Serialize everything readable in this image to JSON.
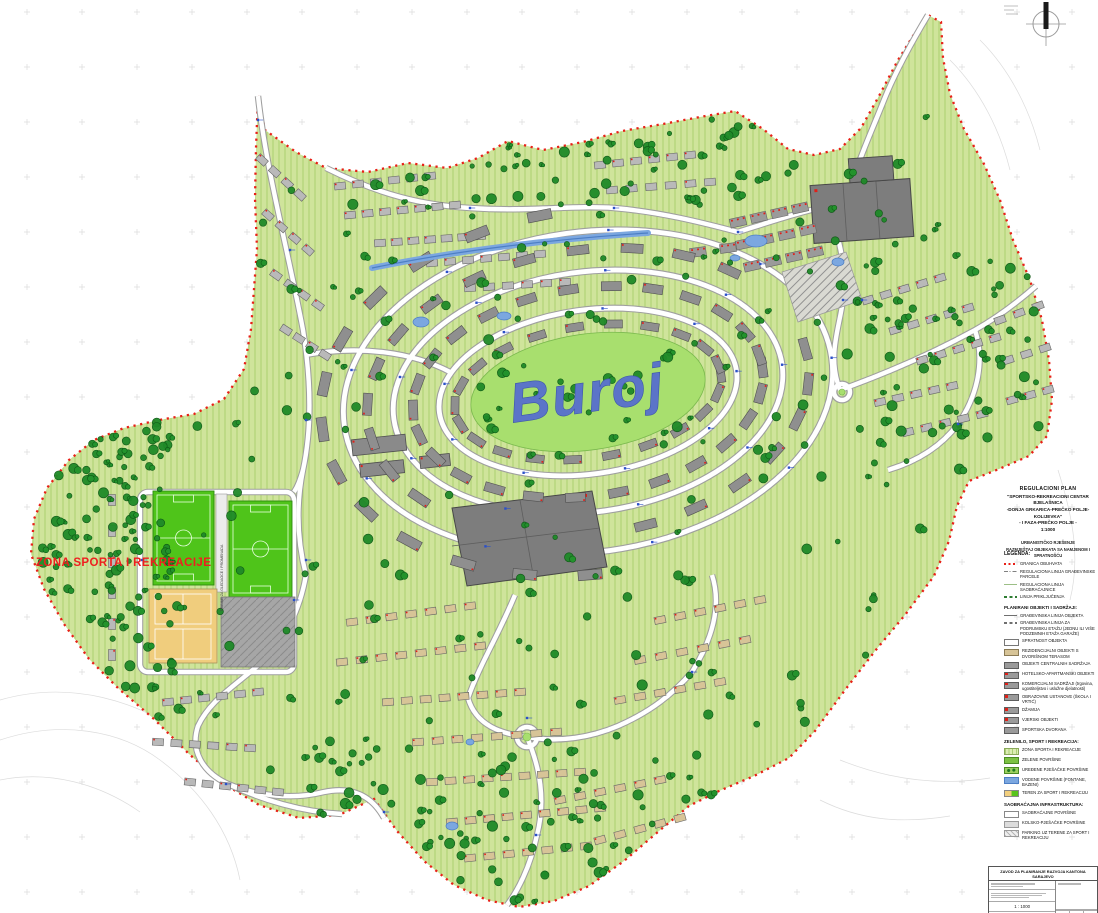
{
  "map": {
    "brand_label": "Buroj",
    "sport_zone_label": "ZONA SPORTA I REKREACIJE",
    "tribune_label": "TRIBINE ZA GLEDAOCE I PROMENADA"
  },
  "title_block": {
    "lines": [
      "REGULACIONI  PLAN",
      "\"SPORTSKO-REKREACIONI CENTAR BJELAŠNICA",
      "-DONJA GRKARICA-PREČKO POLJE-KOLIJEVKA\"",
      "- I FAZA-PREČKO POLJE -",
      "1:1000"
    ],
    "subtitle_lines": [
      "URBANISTIČKO RJEŠENJE",
      "RAZMJEŠTAJ OBJEKATA SA NAMJENOM I SPRATNOŠĆU"
    ]
  },
  "legend": {
    "heading": "LEGENDA:",
    "sections": [
      {
        "header": "",
        "items": [
          {
            "swatch": "line-red-dotted",
            "label": "GRANICA OBUHVATA"
          },
          {
            "swatch": "line-dashdot",
            "label": "REGULACIONA LINIJA GRAĐEVINSKE PARCELE"
          },
          {
            "swatch": "line-thin",
            "label": "REGULACIONA LINIJA SAOBRAĆAJNICE"
          },
          {
            "swatch": "line-green-dashed",
            "label": "LINIJA PRIKLJUČENJA"
          }
        ]
      },
      {
        "header": "PLANIRANI OBJEKTI I SADRŽAJI:",
        "items": [
          {
            "swatch": "line-gray",
            "label": "GRAĐEVINSKA LINIJA OBJEKTA"
          },
          {
            "swatch": "line-gray-dashed",
            "label": "GRAĐEVINSKA LINIJA ZA PODRUMSKU ETAŽU (JEDNU ILI VIŠE PODZEMNIH ETAŽA GARAŽE)"
          },
          {
            "swatch": "box-outline",
            "label": "SPRATNOST OBJEKTA"
          },
          {
            "swatch": "box-tan",
            "label": "REZIDENCIJALNI OBJEKTI S DVORIŠNOM TERASOM"
          },
          {
            "swatch": "box-gray",
            "label": "OBJEKTI CENTRALNIH SADRŽAJA"
          },
          {
            "swatch": "box-gray-red",
            "label": "HOTELSKO-APARTMANSKI OBJEKTI"
          },
          {
            "swatch": "box-gray-red",
            "label": "KOMERCIJALNI SADRŽAJI (trgovina, ugostiteljstvo i uslužne djelatnosti)"
          },
          {
            "swatch": "box-gray-red",
            "label": "OBRAZOVNE USTANOVE (ŠKOLA I VRTIĆ)"
          },
          {
            "swatch": "box-gray-red",
            "label": "DŽAMIJA"
          },
          {
            "swatch": "box-gray-red",
            "label": "VJERSKI OBJEKTI"
          },
          {
            "swatch": "box-gray",
            "label": "SPORTSKA DVORANA"
          }
        ]
      },
      {
        "header": "ZELENILO, SPORT I REKREACIJA:",
        "items": [
          {
            "swatch": "box-hatch-green",
            "label": "ZONA SPORTA I REKREACIJE"
          },
          {
            "swatch": "box-green",
            "label": "ZELENE POVRŠINE"
          },
          {
            "swatch": "box-green-trees",
            "label": "UREĐENE PJEŠAČKE POVRŠINE"
          },
          {
            "swatch": "box-blue",
            "label": "VODENE POVRŠINE (FONTANE, BAZENI)"
          },
          {
            "swatch": "box-sport",
            "label": "TEREN ZA SPORT I REKREACIJU"
          }
        ]
      },
      {
        "header": "SAOBRAĆAJNA INFRASTRUKTURA:",
        "items": [
          {
            "swatch": "box-white",
            "label": "SAOBRAĆAJNE POVRŠINE"
          },
          {
            "swatch": "box-lightgray",
            "label": "KOLSKO-PJEŠAČKE POVRŠINE"
          },
          {
            "swatch": "box-hatch-light",
            "label": "PARKING UZ TERENE ZA SPORT I REKREACIJU"
          }
        ]
      }
    ]
  },
  "stamp": {
    "header": "ZAVOD ZA PLANIRANJE RAZVOJA KANTONA SARAJEVO",
    "scale": "1 : 1000"
  },
  "colors": {
    "site_green": "#cfe49b",
    "hatch_green": "#abd06f",
    "park_green": "#a8df6e",
    "field_green": "#4fc41a",
    "court_yellow": "#f0cd7d",
    "tree_green": "#1f8a28",
    "road_white": "#ffffff",
    "road_casing": "#9f9f9f",
    "building_gray": "#8f8f8f",
    "big_building_gray": "#7d7d7d",
    "house_tan": "#d7c497",
    "water_blue": "#7ba7e0",
    "boundary_red": "#e82018",
    "brand_blue": "#5b74c8",
    "zone_label_red": "#ee1f1f"
  }
}
